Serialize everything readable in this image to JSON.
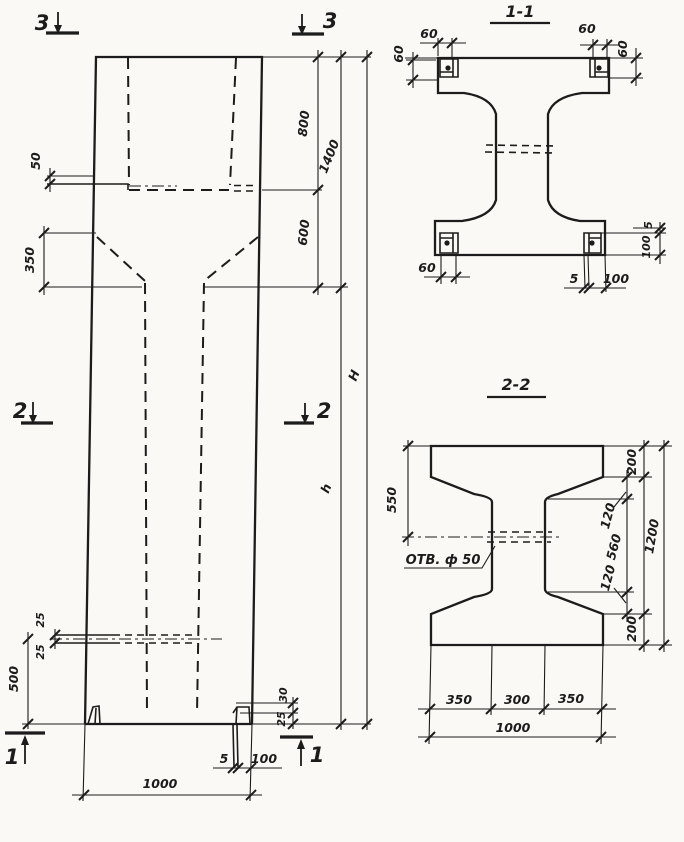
{
  "drawing": {
    "elevation": {
      "markers": {
        "top_left": "3",
        "top_right": "3",
        "middle_left": "2",
        "middle_right": "2",
        "bottom_left": "1",
        "bottom_right": "1"
      },
      "dims": {
        "hole_top_50": "50",
        "head_800": "800",
        "head_1400": "1400",
        "taper_600": "600",
        "taper_350": "350",
        "total_H": "H",
        "shaft_h": "h",
        "hole_25_upper": "25",
        "hole_25_lower": "25",
        "base_500": "500",
        "shoe_30": "30",
        "shoe_25": "25",
        "plate_5": "5",
        "plate_100": "100",
        "width_1000": "1000"
      }
    },
    "section_1_1": {
      "title": "1-1",
      "dims": {
        "top_left_60": "60",
        "left_60": "60",
        "top_right_60": "60",
        "right_60": "60",
        "bottom_left_60": "60",
        "bottom_5": "5",
        "bottom_100": "100",
        "right_5": "5",
        "right_100": "100"
      }
    },
    "section_2_2": {
      "title": "2-2",
      "hole_label": "ОТВ. ф 50",
      "dims": {
        "left_550": "550",
        "top_200": "200",
        "top_120": "120",
        "mid_560": "560",
        "bottom_120": "120",
        "bottom_200": "200",
        "right_1200": "1200",
        "bottom_350_left": "350",
        "bottom_300": "300",
        "bottom_350_right": "350",
        "bottom_1000": "1000"
      }
    }
  }
}
